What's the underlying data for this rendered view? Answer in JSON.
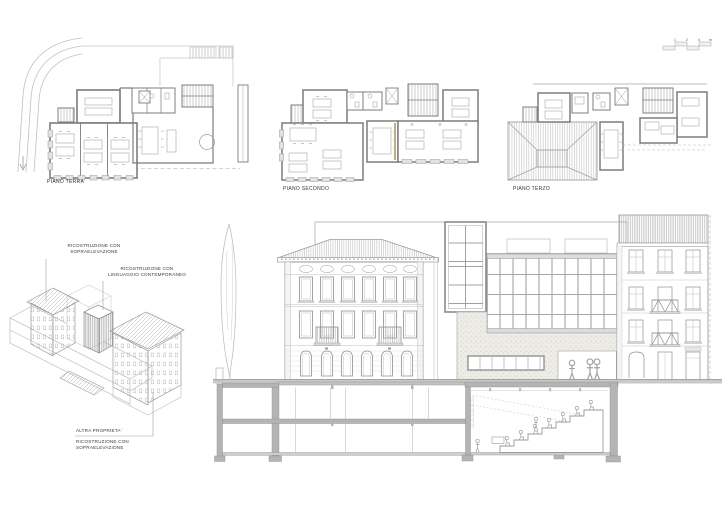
{
  "sheet": {
    "background": "#ffffff",
    "description": "Architectural presentation sheet: three floor plans, axonometric massing diagram, street elevation and longitudinal section"
  },
  "colors": {
    "line_xlight": "#cccccc",
    "line_light": "#b3b3b3",
    "line_mid": "#909090",
    "line_dark": "#6d6d6d",
    "poche": "#b4b4b4",
    "slab": "#c9c9c9",
    "stipple_bg": "#edece6",
    "accent_olive": "#9a8433",
    "text": "#333333"
  },
  "plans": [
    {
      "id": "piano-terra",
      "label": "PIANO TERRA"
    },
    {
      "id": "piano-secondo",
      "label": "PIANO SECONDO"
    },
    {
      "id": "piano-terzo",
      "label": "PIANO TERZO"
    }
  ],
  "scale_bar": {
    "tick_labels": [
      "1",
      "2",
      "4",
      "m"
    ]
  },
  "axonometric": {
    "annotations": [
      {
        "id": "ricostruzione-sopraelevazione-sx",
        "lines": [
          "RICOSTRUZIONE CON",
          "SOPRAELEVAZIONE"
        ]
      },
      {
        "id": "ricostruzione-linguaggio-contemporaneo",
        "lines": [
          "RICOSTRUZIONE CON",
          "LINGUAGGIO CONTEMPORANEO"
        ]
      },
      {
        "id": "altra-proprieta",
        "lines": [
          "ALTRA PROPRIETA'"
        ]
      },
      {
        "id": "ricostruzione-sopraelevazione-dx",
        "lines": [
          "RICOSTRUZIONE CON",
          "SOPRAELEVAZIONE"
        ]
      }
    ]
  }
}
